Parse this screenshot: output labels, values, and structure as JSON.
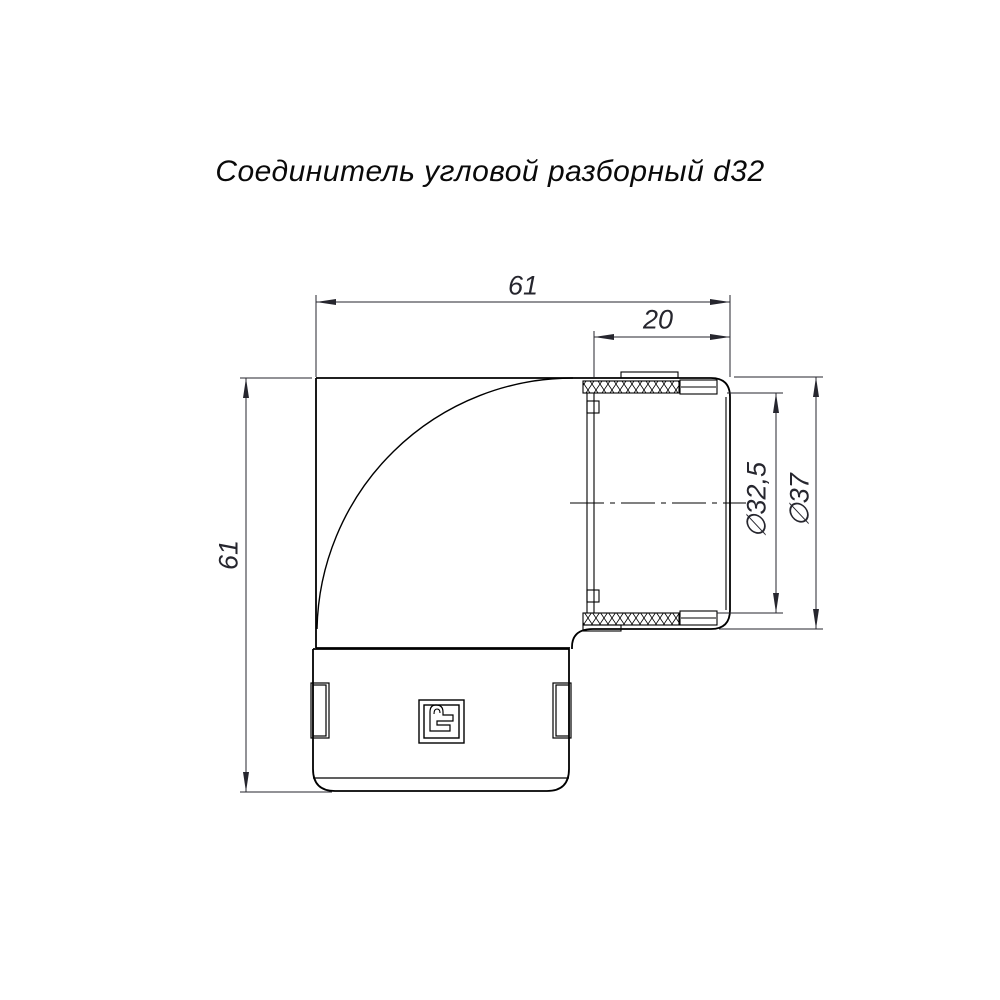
{
  "title": "Соединитель угловой разборный d32",
  "dimensions": {
    "overall_width": "61",
    "socket_depth": "20",
    "overall_height": "61",
    "inner_diameter": "∅32,5",
    "outer_diameter": "∅37"
  },
  "colors": {
    "line": "#000000",
    "dim_text": "#26262e",
    "background": "#ffffff"
  },
  "icons": {
    "brand_stamp": "brand-stamp-icon"
  }
}
